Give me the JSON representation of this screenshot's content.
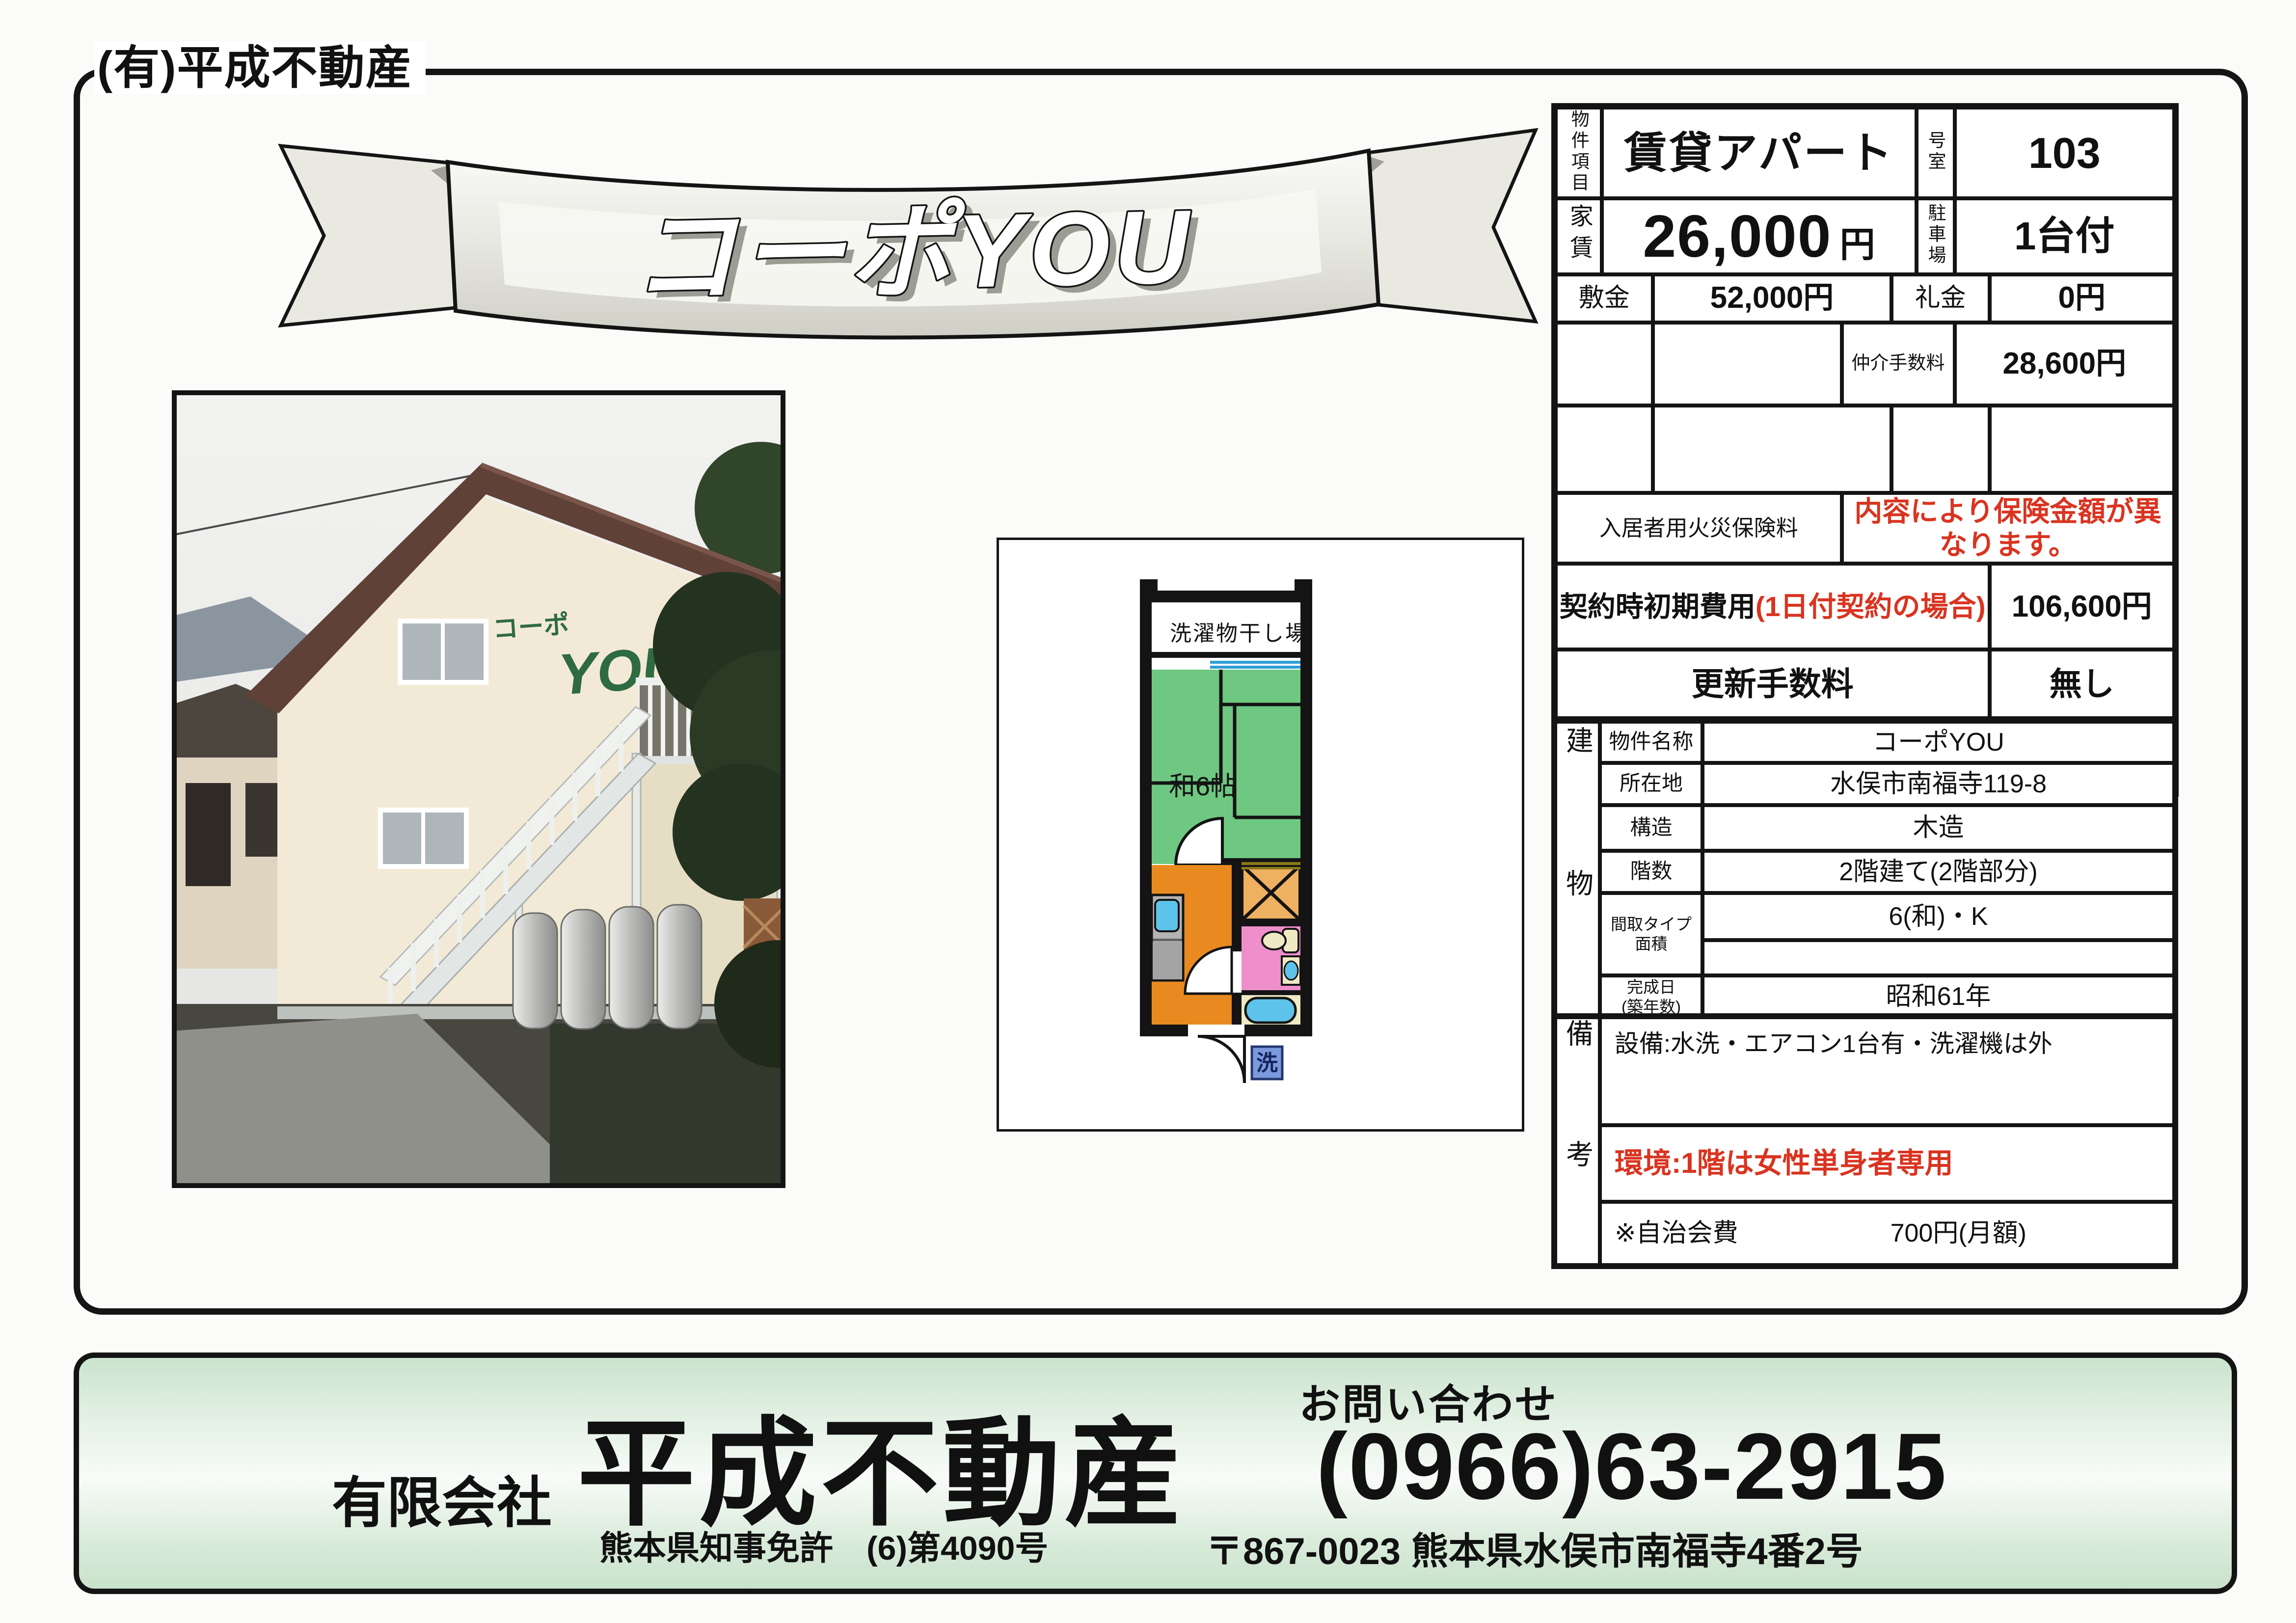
{
  "page": {
    "company_tag": "(有)平成不動産"
  },
  "banner": {
    "title": "コーポYOU"
  },
  "photo": {
    "sign_kana": "コーポ",
    "sign_text": "YOU"
  },
  "floorplan": {
    "balcony_label": "洗濯物干し場",
    "room_label": "和6帖",
    "washer_label": "洗"
  },
  "listing": {
    "item_label": "物件項目",
    "item_value": "賃貸アパート",
    "room_no_label": "号室",
    "room_no": "103",
    "rent_label": "家賃",
    "rent": "26,000",
    "rent_unit": "円",
    "parking_label": "駐車場",
    "parking": "1台付",
    "deposit_label": "敷金",
    "deposit": "52,000円",
    "key_money_label": "礼金",
    "key_money": "0円",
    "broker_fee_label": "仲介手数料",
    "broker_fee": "28,600円",
    "fire_label": "入居者用火災保険料",
    "fire_note": "内容により保険金額が異なります。",
    "initial_label": "契約時初期費用",
    "initial_label_red": "(1日付契約の場合)",
    "initial_value": "106,600円",
    "renewal_label": "更新手数料",
    "renewal_value": "無し",
    "transport_label": "交通",
    "transport_value": "内山バス停　約80m"
  },
  "building": {
    "section_label": "建物",
    "rows": [
      {
        "label": "物件名称",
        "value": "コーポYOU"
      },
      {
        "label": "所在地",
        "value": "水俣市南福寺119-8"
      },
      {
        "label": "構造",
        "value": "木造"
      },
      {
        "label": "階数",
        "value": "2階建て(2階部分)"
      },
      {
        "label": "間取タイプ",
        "label2": "面積",
        "value": "6(和)・K"
      },
      {
        "label": "完成日",
        "label2": "(築年数)",
        "value": "昭和61年"
      }
    ]
  },
  "remarks": {
    "section_label": "備考",
    "equipment": "設備:水洗・エアコン1台有・洗濯機は外",
    "environment": "環境:1階は女性単身者専用",
    "fee_label": "※自治会費",
    "fee_value": "700円(月額)"
  },
  "footer": {
    "company_prefix": "有限会社",
    "company_name": "平成不動産",
    "license": "熊本県知事免許　(6)第4090号",
    "contact_label": "お問い合わせ",
    "phone": "(0966)63-2915",
    "address": "〒867-0023 熊本県水俣市南福寺4番2号"
  },
  "colors": {
    "accent_red": "#d93420",
    "tatami_green": "#6fc882",
    "kitchen_orange": "#e88a20",
    "closet_orange": "#eeb061",
    "bath_pink": "#ee8fcb",
    "water_blue": "#5ec3ea",
    "counter_gray": "#b3b3b3",
    "fixture_cream": "#efe9c4",
    "washer_blue": "#7b99dc",
    "footer_green": "#d5e9d6",
    "sign_green": "#2e6b40"
  }
}
